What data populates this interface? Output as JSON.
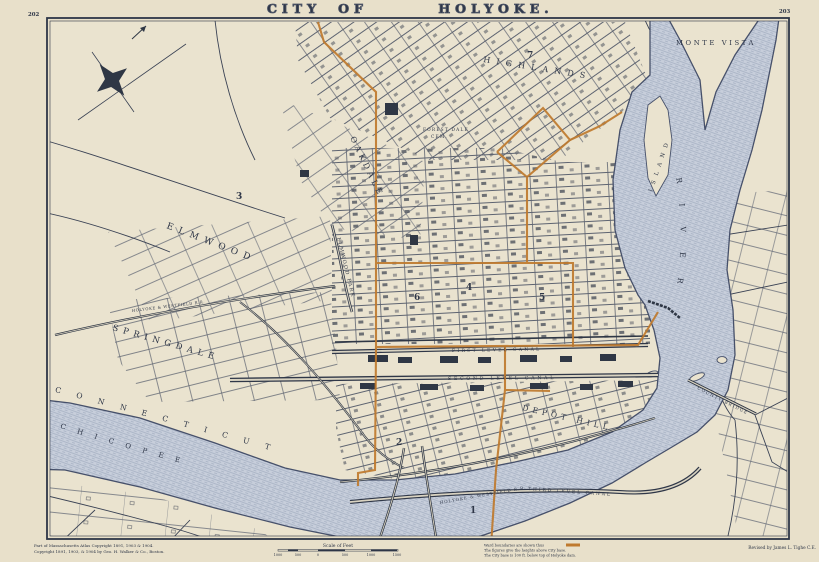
{
  "page": {
    "left_number": "202",
    "right_number": "203"
  },
  "title": {
    "city": "CITY",
    "of": "OF",
    "holyoke": "HOLYOKE."
  },
  "districts": {
    "monte_vista": "MONTE VISTA",
    "highlands": "HIGHLANDS",
    "oakdale": "OAKDALE",
    "elmwood": "ELMWOOD",
    "elmwood_park": "ELMWOOD PARK",
    "springdale": "SPRINGDALE",
    "depot_hill": "DEPOT HILL",
    "chicopee": "CHICOPEE",
    "forest_dale_line1": "FOREST DALE",
    "forest_dale_line2": "CEM."
  },
  "water": {
    "connecticut": "CONNECTICUT",
    "river": "RIVER",
    "island": "ISLAND"
  },
  "canals": {
    "first": "FIRST LEVEL CANAL",
    "second": "SECOND LEVEL CANAL",
    "third": "THIRD LEVEL CANAL"
  },
  "railroads": {
    "holyoke_westfield": "HOLYOKE & WESTFIELD R.R."
  },
  "bridges": {
    "county": "COUNTY BRIDGE"
  },
  "wards": [
    "1",
    "2",
    "3",
    "4",
    "5",
    "6",
    "7"
  ],
  "legend": {
    "line1": "Ward boundaries are shown thus",
    "line2": "The figures give the heights above City base.",
    "line3": "The City base is 100 ft. below top of Holyoke dam.",
    "swatch_color": "#bf7a2e"
  },
  "scale": {
    "label": "Scale of Feet",
    "ticks": [
      "1000",
      "500",
      "0",
      "500",
      "1000",
      "1500"
    ]
  },
  "credits": {
    "copyright_line1": "Part of Massachusetts Atlas Copyright 1891, 1903 & 1904.",
    "copyright_line2": "Copyright 1891, 1903, & 1904 by Geo. H. Walker & Co., Boston.",
    "revised": "Revised by James L. Tighe C.E."
  },
  "colors": {
    "paper": "#eae3cf",
    "ink": "#2e3647",
    "water_fill": "#c7cedb",
    "water_line": "#46506a",
    "ward_line": "#bf7a2e"
  }
}
